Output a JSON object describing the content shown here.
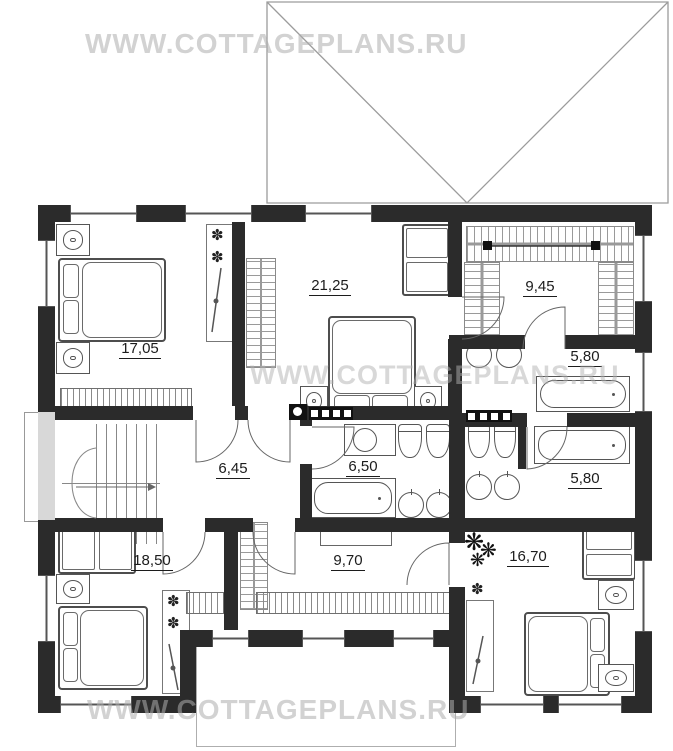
{
  "watermarks": {
    "top": "WWW.COTTAGEPLANS.RU",
    "middle": "WWW.COTTAGEPLANS.RU",
    "bottom": "WWW.COTTAGEPLANS.RU"
  },
  "rooms": [
    {
      "id": "bedroom-top-left",
      "area": "17,05"
    },
    {
      "id": "bedroom-top-middle",
      "area": "21,25"
    },
    {
      "id": "dressing-room",
      "area": "9,45"
    },
    {
      "id": "bathroom-top-right",
      "area": "5,80"
    },
    {
      "id": "hall",
      "area": "6,45"
    },
    {
      "id": "bathroom-middle",
      "area": "6,50"
    },
    {
      "id": "bathroom-right",
      "area": "5,80"
    },
    {
      "id": "bedroom-bottom-left",
      "area": "18,50"
    },
    {
      "id": "corridor",
      "area": "9,70"
    },
    {
      "id": "bedroom-bottom-right",
      "area": "16,70"
    }
  ],
  "icons": {
    "plant": "❋",
    "flower": "✽"
  },
  "colors": {
    "wall": "#2b2b2b",
    "furniture_line": "#555555",
    "roof_line": "#9c9c9c",
    "watermark": "#adadad"
  }
}
